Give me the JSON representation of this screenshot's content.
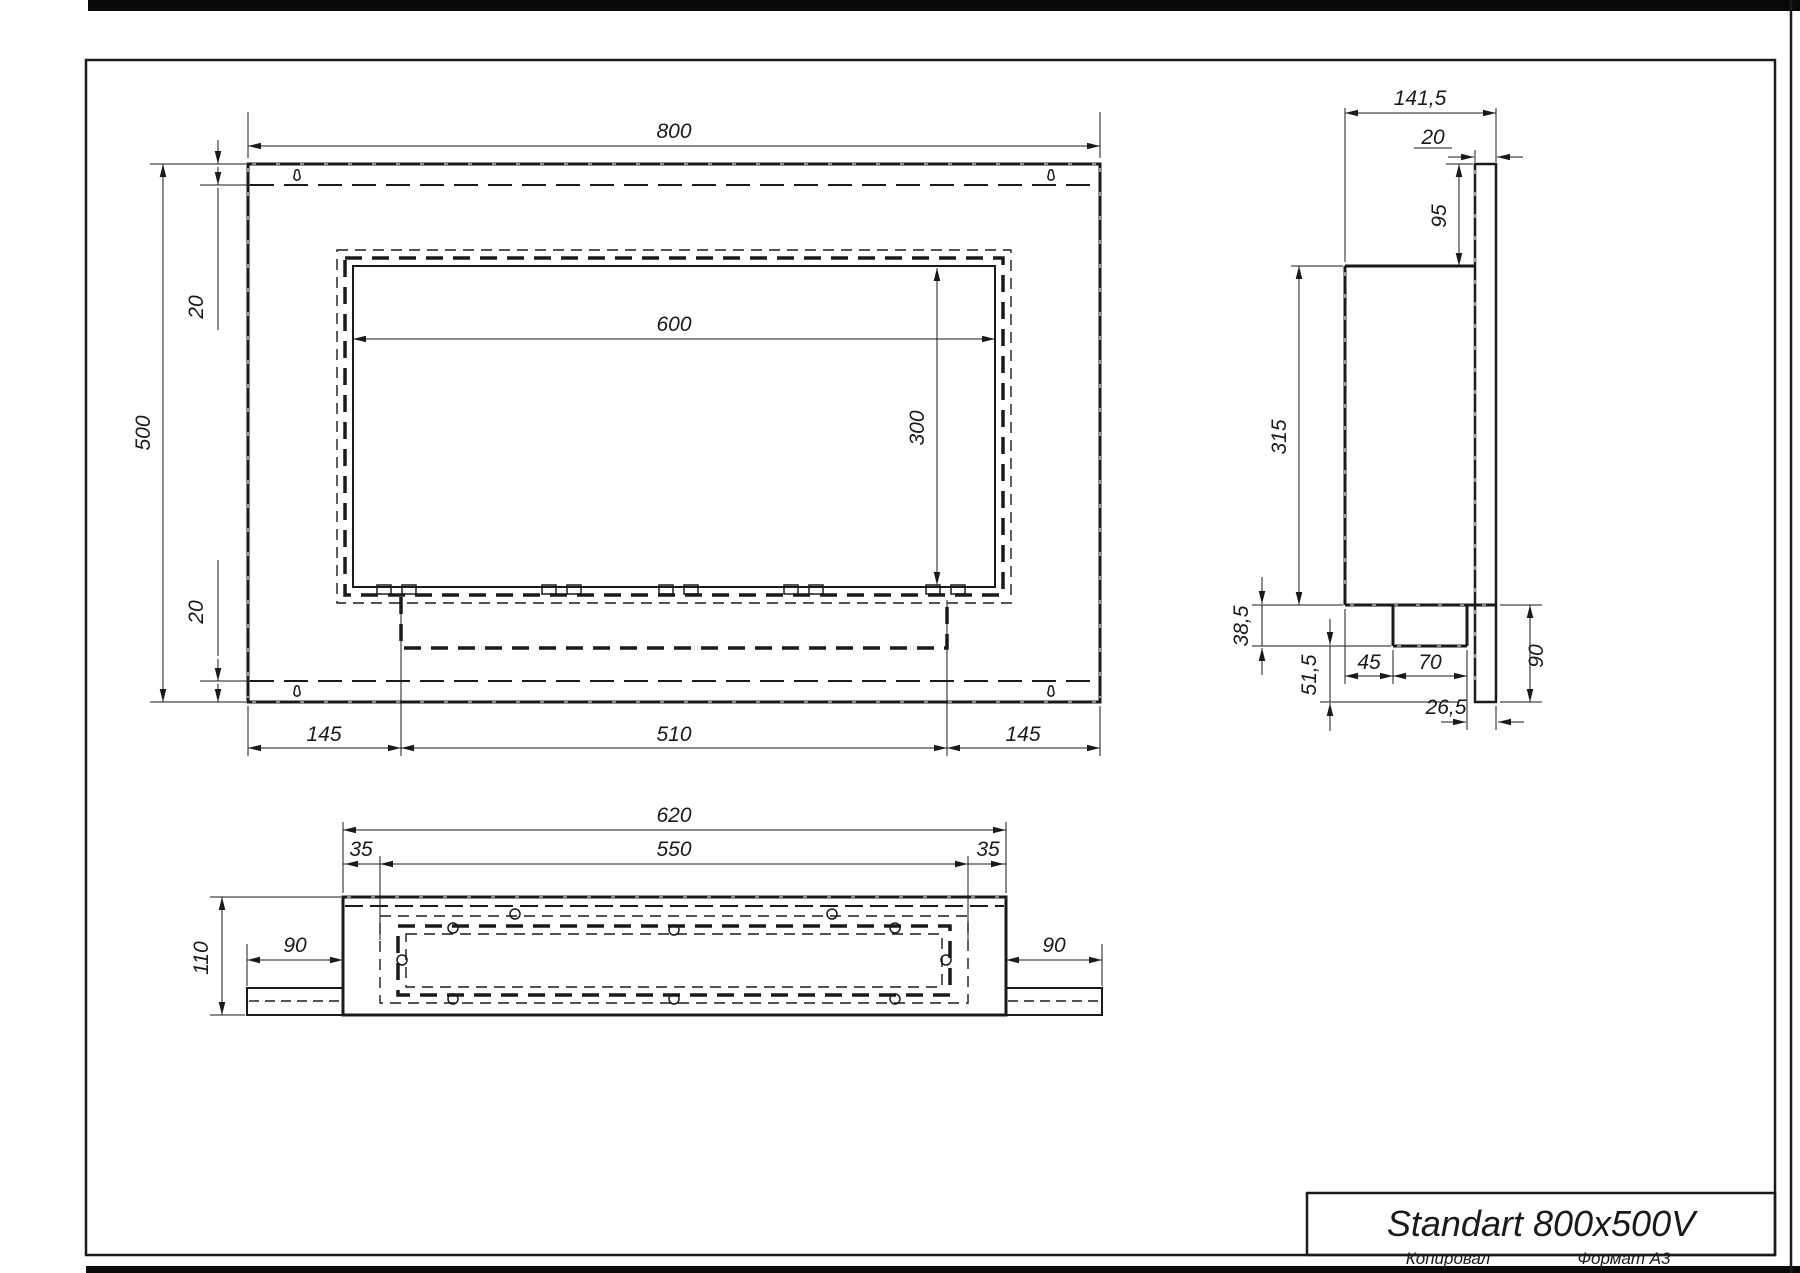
{
  "title_block": {
    "title": "Standart 800x500V",
    "footer_left": "Копировал",
    "footer_right": "Формат А3"
  },
  "front_view": {
    "dims": {
      "width": "800",
      "height": "500",
      "top_inset": "20",
      "bottom_inset": "20",
      "opening_width": "600",
      "opening_height": "300",
      "left_margin": "145",
      "burner_width": "510",
      "right_margin": "145"
    }
  },
  "side_view": {
    "dims": {
      "depth": "141,5",
      "plate_thickness": "20",
      "top_to_box": "95",
      "box_height": "315",
      "under_box": "38,5",
      "lower_leg": "51,5",
      "front_gap": "45",
      "tray_width": "70",
      "back_gap": "26,5",
      "lower_height": "90"
    }
  },
  "bottom_view": {
    "dims": {
      "outer_width": "620",
      "inner_width": "550",
      "left_inset": "35",
      "right_inset": "35",
      "depth": "110",
      "left_flange": "90",
      "right_flange": "90"
    }
  },
  "colors": {
    "line": "#1a1a1a",
    "background": "#ffffff"
  }
}
